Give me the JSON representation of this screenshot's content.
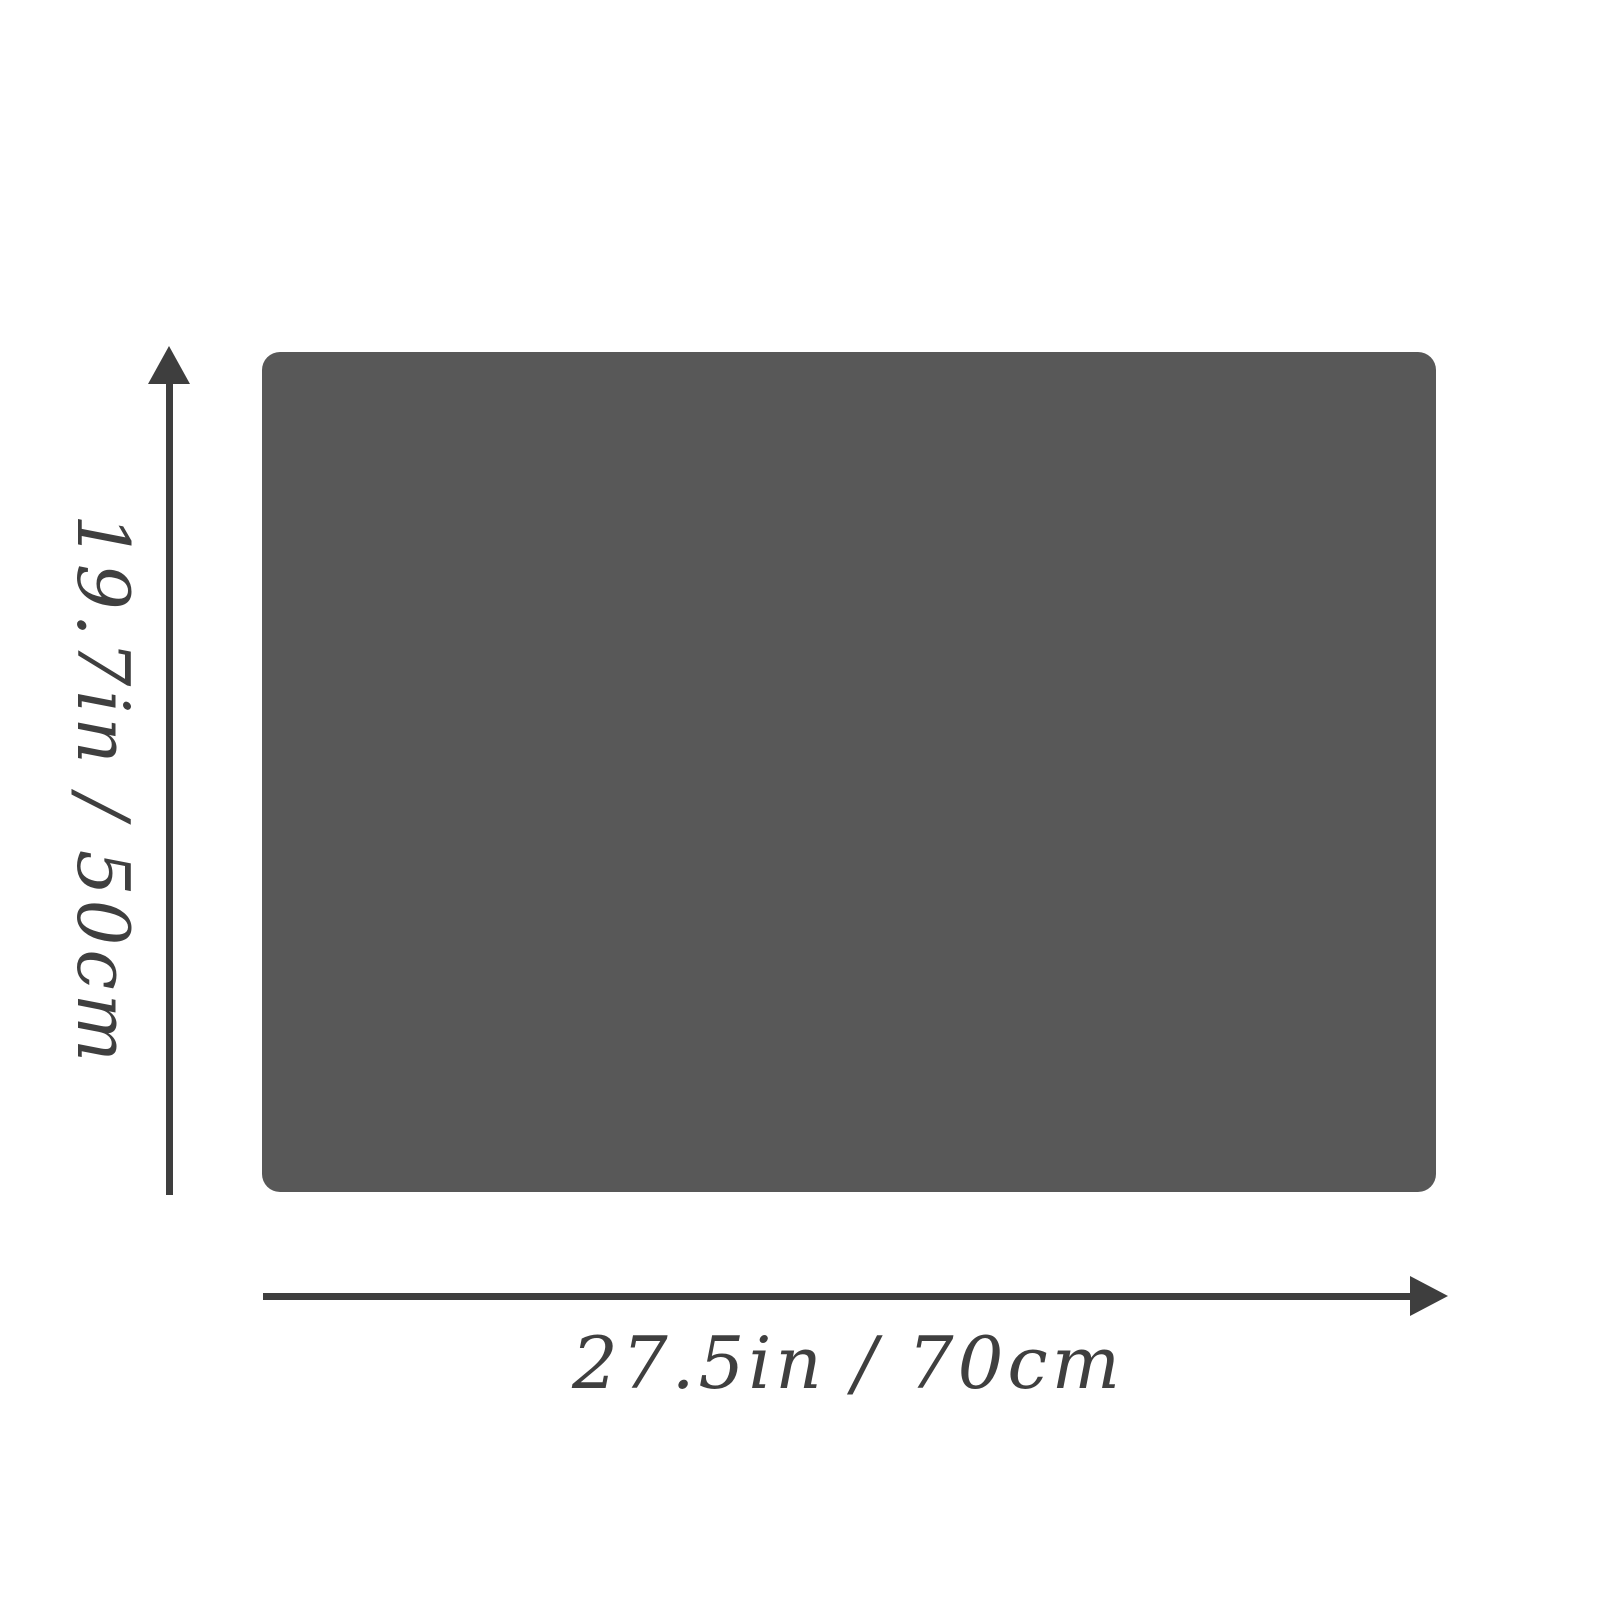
{
  "diagram": {
    "type": "product-dimension-diagram",
    "background_color": "#ffffff",
    "item": {
      "shape": "rounded-rectangle",
      "fill_color": "#585858"
    },
    "dimensions": {
      "height": {
        "label": "19.7in / 50cm",
        "arrow_direction": "up",
        "label_rotation_deg": 90
      },
      "width": {
        "label": "27.5in / 70cm",
        "arrow_direction": "right"
      }
    },
    "colors": {
      "dimension_line": "#3e3e3e",
      "label_text": "#3f3f3f"
    }
  }
}
